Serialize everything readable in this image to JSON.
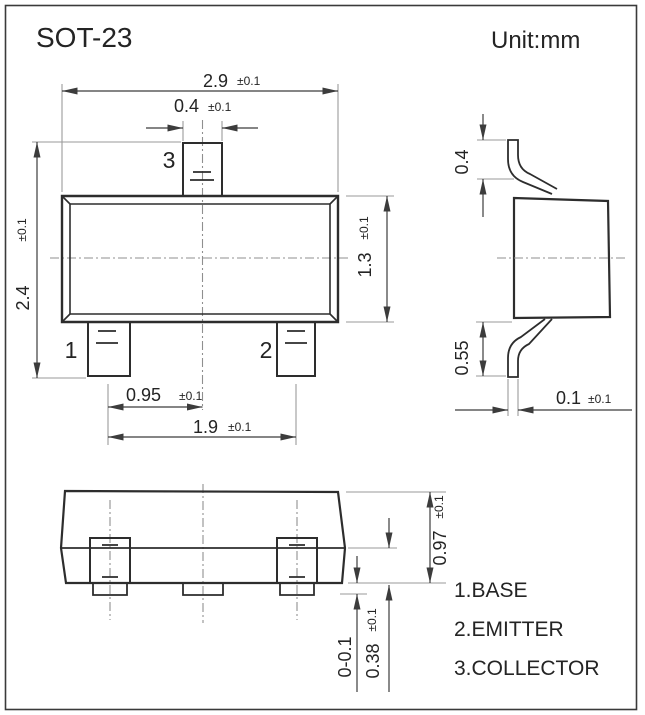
{
  "title": "SOT-23",
  "unit_label": "Unit:mm",
  "front_view": {
    "pin_numbers": {
      "pin1": "1",
      "pin2": "2",
      "pin3": "3"
    },
    "dimensions": {
      "body_width": {
        "value": "2.9",
        "tolerance": "±0.1"
      },
      "pin_width": {
        "value": "0.4",
        "tolerance": "±0.1"
      },
      "overall_height": {
        "value": "2.4",
        "tolerance": "±0.1"
      },
      "body_height": {
        "value": "1.3",
        "tolerance": "±0.1"
      },
      "pin_pitch": {
        "value": "0.95",
        "tolerance": "±0.1"
      },
      "pin_span": {
        "value": "1.9",
        "tolerance": "±0.1"
      }
    }
  },
  "side_view": {
    "dimensions": {
      "upper_lead_height": {
        "value": "0.4"
      },
      "lower_lead_height": {
        "value": "0.55"
      },
      "lead_thickness": {
        "value": "0.1",
        "tolerance": "±0.1"
      }
    }
  },
  "bottom_view": {
    "dimensions": {
      "body_thickness": {
        "value": "0.97",
        "tolerance": "±0.1"
      },
      "standoff": {
        "value": "0-0.1"
      },
      "base_to_seating": {
        "value": "0.38",
        "tolerance": "±0.1"
      }
    }
  },
  "legend": [
    "1.BASE",
    "2.EMITTER",
    "3.COLLECTOR"
  ],
  "colors": {
    "outline": "#2d2d2d",
    "dimension_lines": "#3c3c3c",
    "extension_lines": "#9a9a9a",
    "centerlines": "#8f8f8f",
    "text": "#242424",
    "background": "#ffffff"
  }
}
